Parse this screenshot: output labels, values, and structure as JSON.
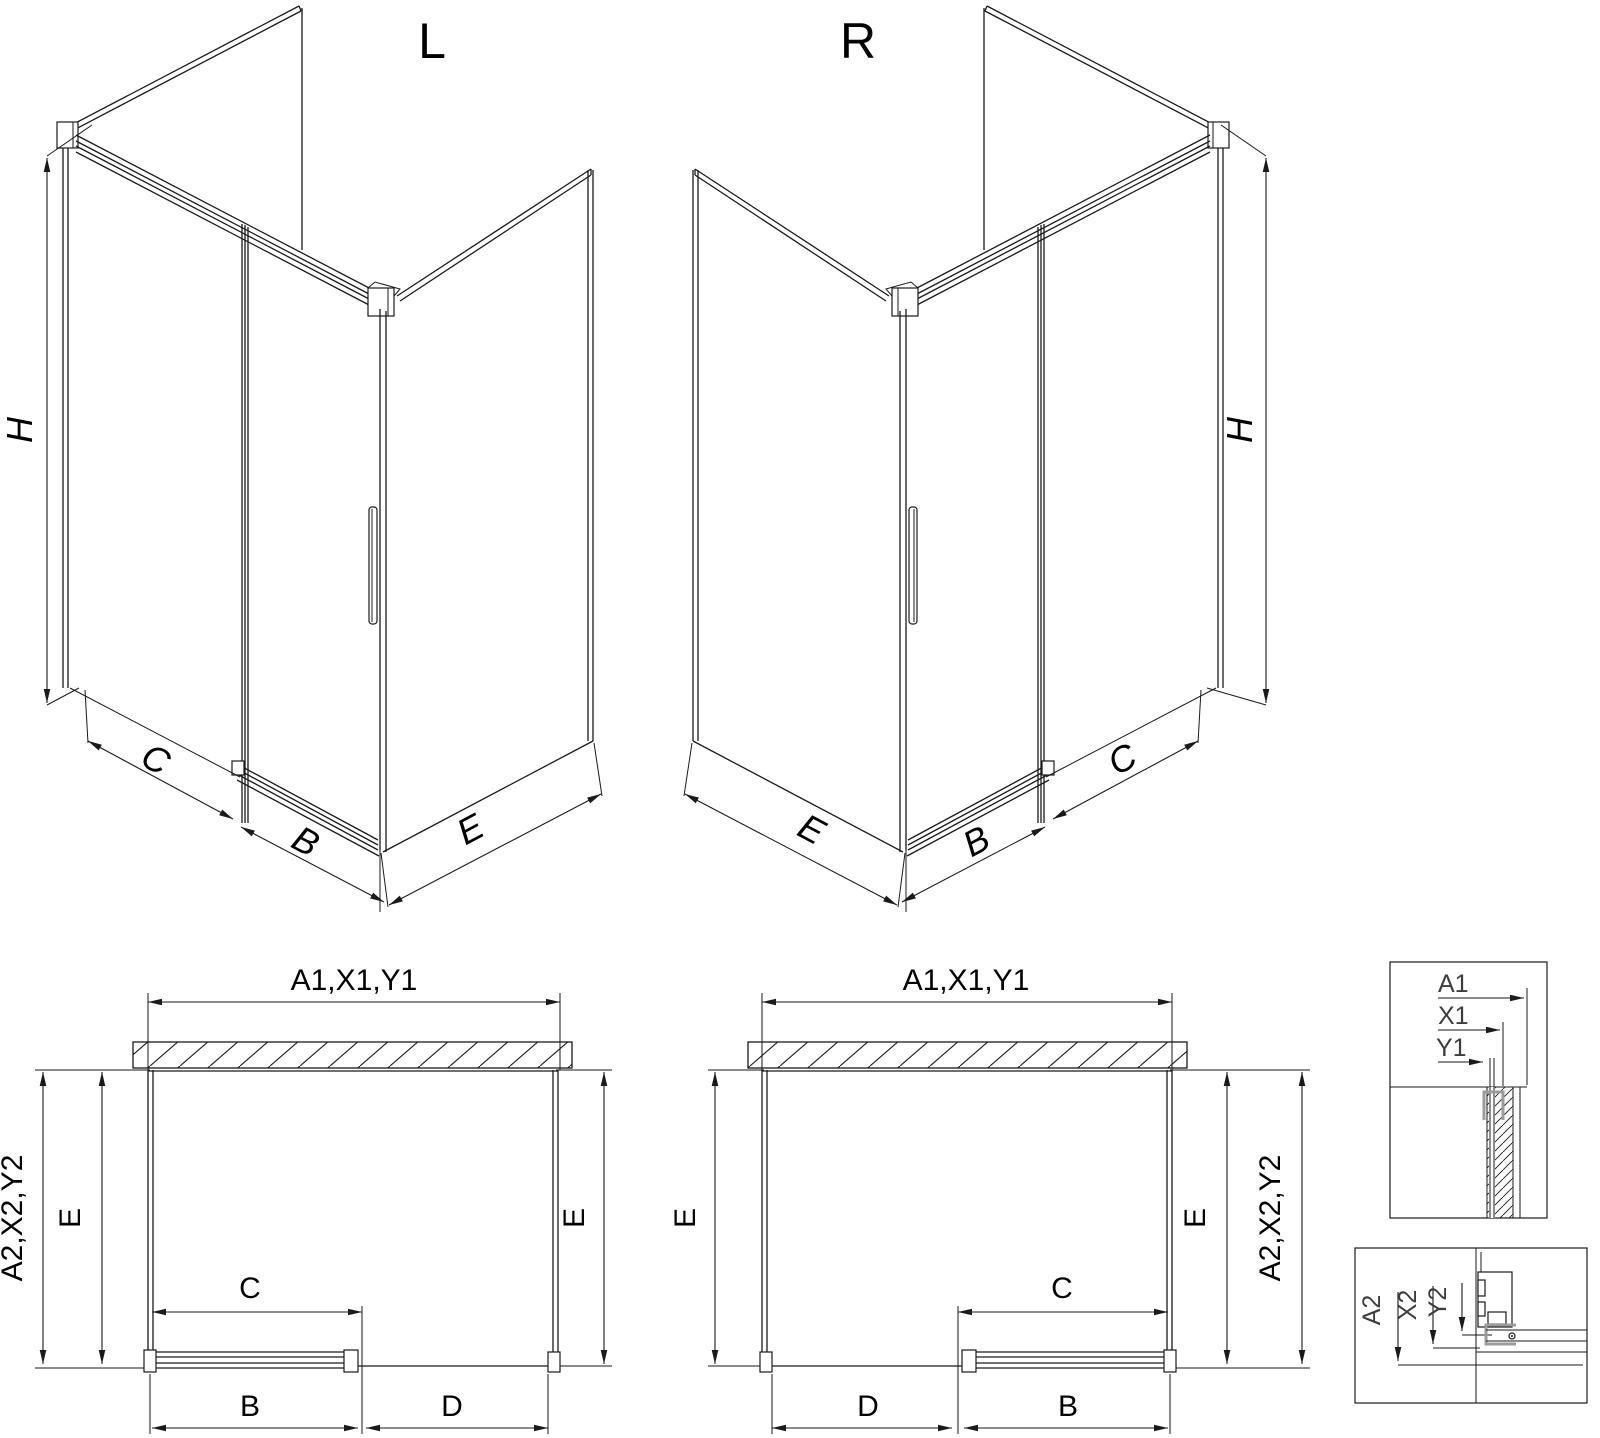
{
  "title": "shower-enclosure-technical-drawing",
  "colors": {
    "line": "#1a1a1a",
    "profile_gray": "#9b9b9b",
    "background": "#ffffff"
  },
  "views": {
    "left": {
      "label": "L"
    },
    "right": {
      "label": "R"
    }
  },
  "dims": {
    "h": "H",
    "b": "B",
    "c": "C",
    "d": "D",
    "e": "E",
    "top_combo": "A1,X1,Y1",
    "depth_combo": "A2,X2,Y2"
  },
  "details": {
    "top": {
      "a1": "A1",
      "x1": "X1",
      "y1": "Y1"
    },
    "bottom": {
      "a2": "A2",
      "x2": "X2",
      "y2": "Y2"
    }
  }
}
